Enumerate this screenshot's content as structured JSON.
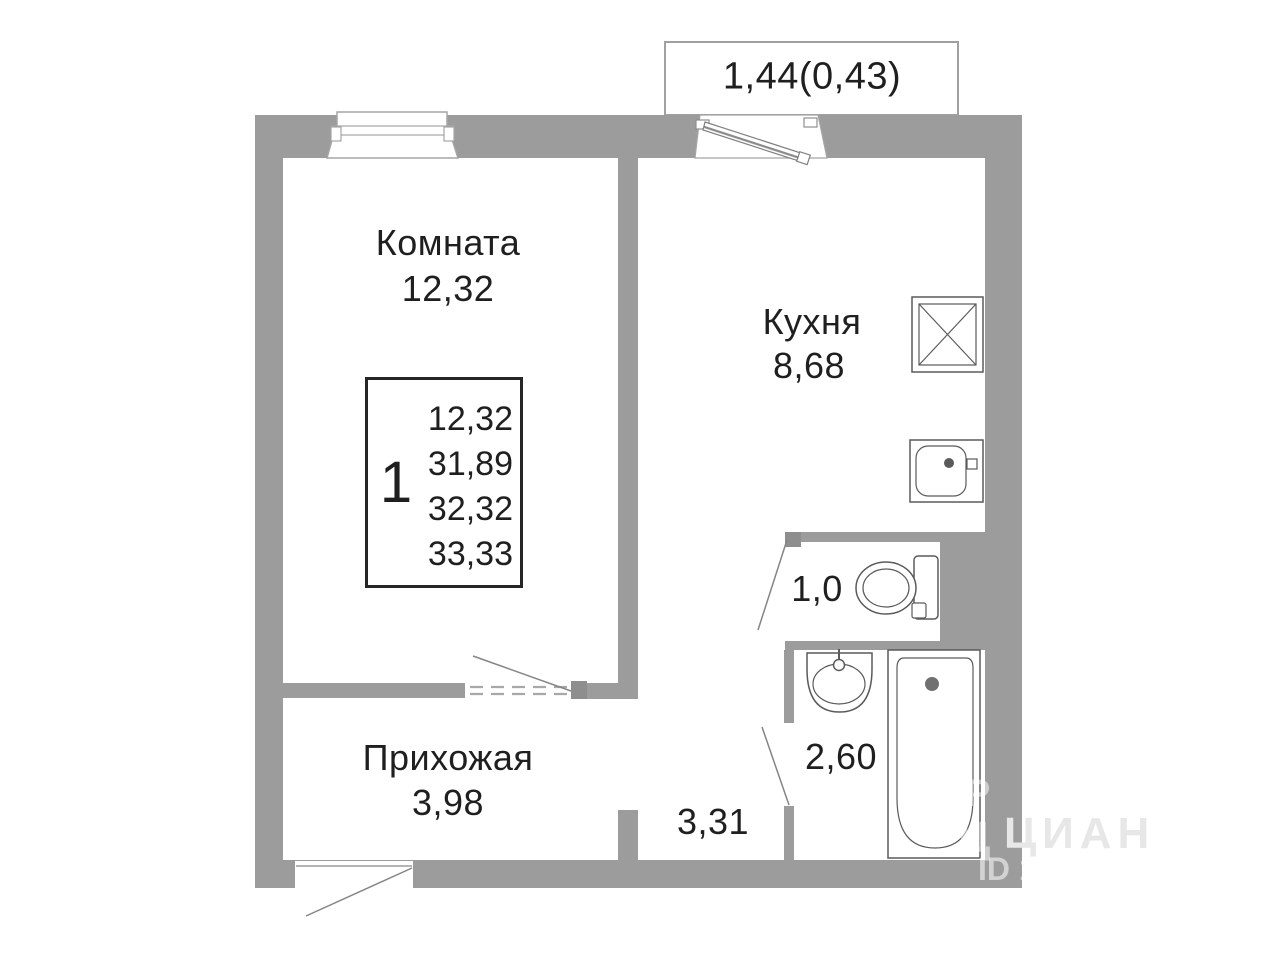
{
  "plan": {
    "balcony": {
      "label": "1,44(0,43)"
    },
    "rooms": {
      "room": {
        "name": "Комната",
        "area": "12,32"
      },
      "kitchen": {
        "name": "Кухня",
        "area": "8,68"
      },
      "hallway": {
        "name": "Прихожая",
        "area": "3,98"
      },
      "wc": {
        "area": "1,0"
      },
      "bathroom": {
        "area": "2,60"
      },
      "corridor": {
        "area": "3,31"
      }
    },
    "info_box": {
      "rooms_count": "1",
      "areas": [
        "12,32",
        "31,89",
        "32,32",
        "33,33"
      ]
    },
    "watermark": {
      "letter": "Р",
      "brand": "ЦИАН",
      "id_text": "ID 1"
    },
    "colors": {
      "wall": "#9c9c9c",
      "outline": "#5a5a5a",
      "text": "#1f1f1f"
    }
  }
}
